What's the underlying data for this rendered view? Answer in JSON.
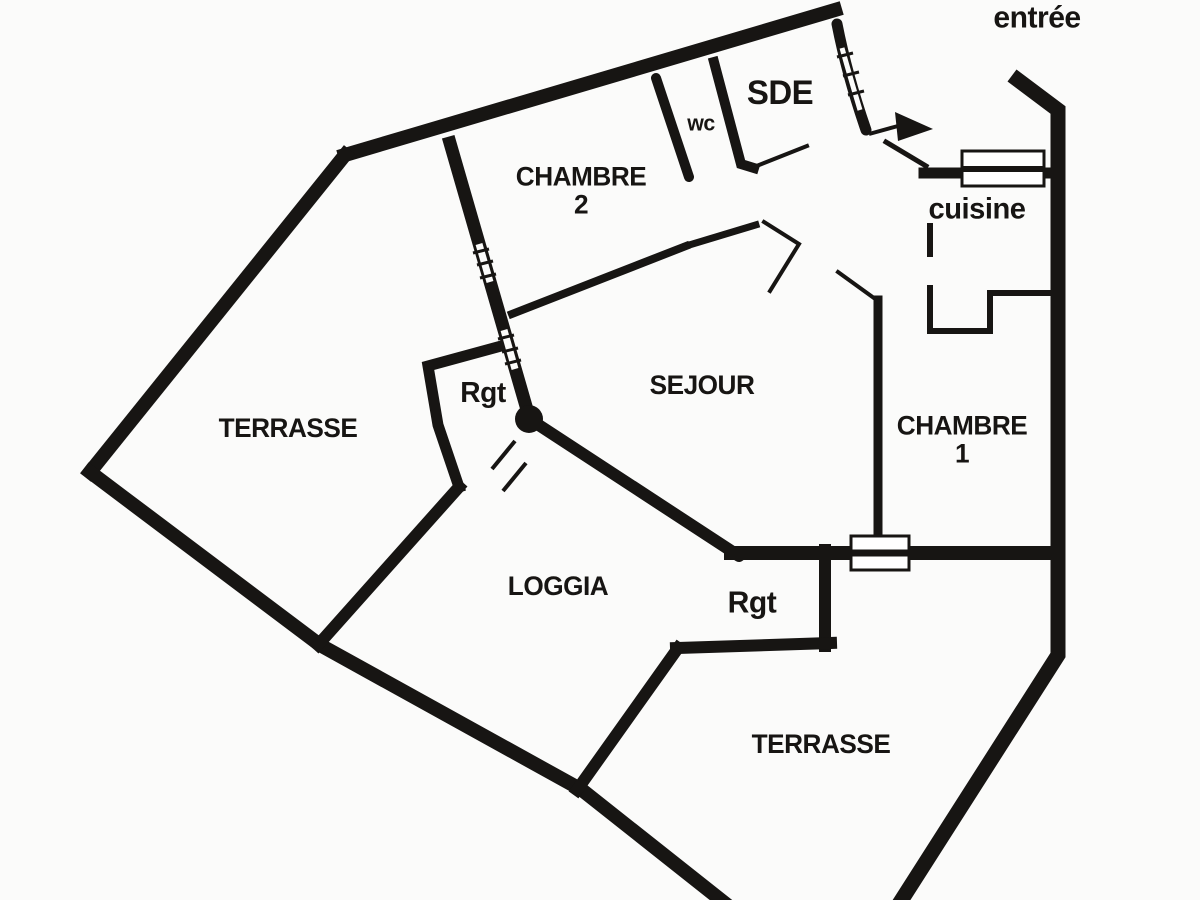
{
  "plan": {
    "background": "#fbfbfa",
    "wall_color": "#171513",
    "text_color": "#171513"
  },
  "labels": {
    "entree": "entrée",
    "sde": "SDE",
    "wc": "wc",
    "chambre2_line1": "CHAMBRE",
    "chambre2_line2": "2",
    "cuisine": "cuisine",
    "terrasse_left": "TERRASSE",
    "rgt_top": "Rgt",
    "sejour": "SEJOUR",
    "chambre1_line1": "CHAMBRE",
    "chambre1_line2": "1",
    "loggia": "LOGGIA",
    "rgt_bottom": "Rgt",
    "terrasse_bottom": "TERRASSE"
  }
}
